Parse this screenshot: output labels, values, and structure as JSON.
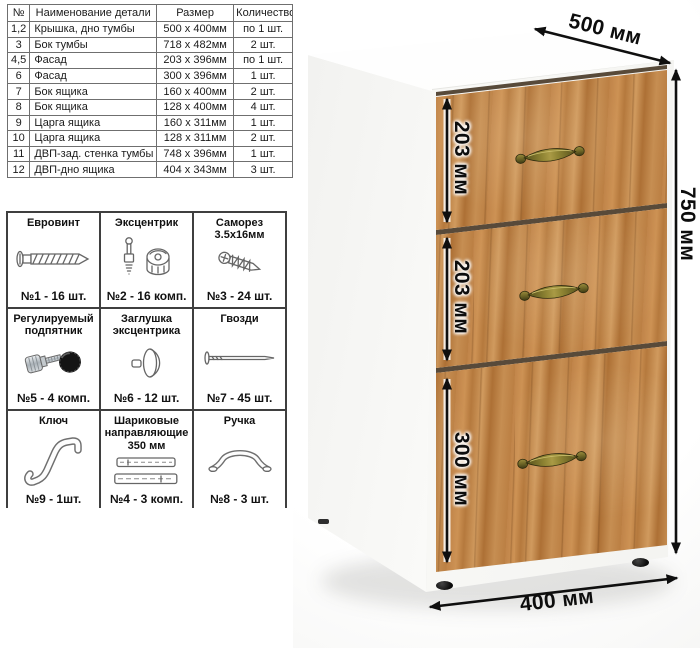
{
  "parts_table": {
    "headers": [
      "№",
      "Наименование детали",
      "Размер",
      "Количество"
    ],
    "rows": [
      [
        "1,2",
        "Крышка, дно тумбы",
        "500 х 400мм",
        "по 1 шт."
      ],
      [
        "3",
        "Бок тумбы",
        "718 х 482мм",
        "2 шт."
      ],
      [
        "4,5",
        "Фасад",
        "203 х 396мм",
        "по 1 шт."
      ],
      [
        "6",
        "Фасад",
        "300 х 396мм",
        "1 шт."
      ],
      [
        "7",
        "Бок ящика",
        "160 х 400мм",
        "2 шт."
      ],
      [
        "8",
        "Бок ящика",
        "128 х 400мм",
        "4 шт."
      ],
      [
        "9",
        "Царга ящика",
        "160 х 311мм",
        "1 шт."
      ],
      [
        "10",
        "Царга ящика",
        "128 х 311мм",
        "2 шт."
      ],
      [
        "11",
        "ДВП-зад. стенка тумбы",
        "748 х 396мм",
        "1 шт."
      ],
      [
        "12",
        "ДВП-дно ящика",
        "404 х 343мм",
        "3 шт."
      ]
    ]
  },
  "hardware": {
    "items": [
      {
        "title": "Евровинт",
        "count": "№1 - 16 шт.",
        "icon": "confirmat-screw-icon"
      },
      {
        "title": "Эксцентрик",
        "count": "№2 - 16 комп.",
        "icon": "cam-lock-icon"
      },
      {
        "title": "Саморез 3.5х16мм",
        "count": "№3 - 24 шт.",
        "icon": "self-tapping-screw-icon"
      },
      {
        "title": "Регулируемый подпятник",
        "count": "№5 - 4 комп.",
        "icon": "adjustable-foot-icon"
      },
      {
        "title": "Заглушка эксцентрика",
        "count": "№6 - 12 шт.",
        "icon": "cam-cover-icon"
      },
      {
        "title": "Гвозди",
        "count": "№7 - 45 шт.",
        "icon": "nail-icon"
      },
      {
        "title": "Ключ",
        "count": "№9 - 1шт.",
        "icon": "hex-key-icon"
      },
      {
        "title": "Шариковые направляющие 350 мм",
        "count": "№4 - 3 комп.",
        "icon": "ball-slides-icon"
      },
      {
        "title": "Ручка",
        "count": "№8 - 3 шт.",
        "icon": "drawer-handle-icon"
      }
    ]
  },
  "cabinet": {
    "dimensions": {
      "depth": "500 мм",
      "height": "750 мм",
      "width": "400 мм",
      "drawer_top": "203 мм",
      "drawer_middle": "203 мм",
      "drawer_bottom": "300 мм"
    },
    "colors": {
      "wood": "#bd8246",
      "wood_light": "#d29a5e",
      "wood_dark": "#a06a32",
      "handle_bronze": "#7a7030",
      "carcass_white": "#f8f8f6",
      "dimension_text": "#0f0f0f"
    }
  }
}
